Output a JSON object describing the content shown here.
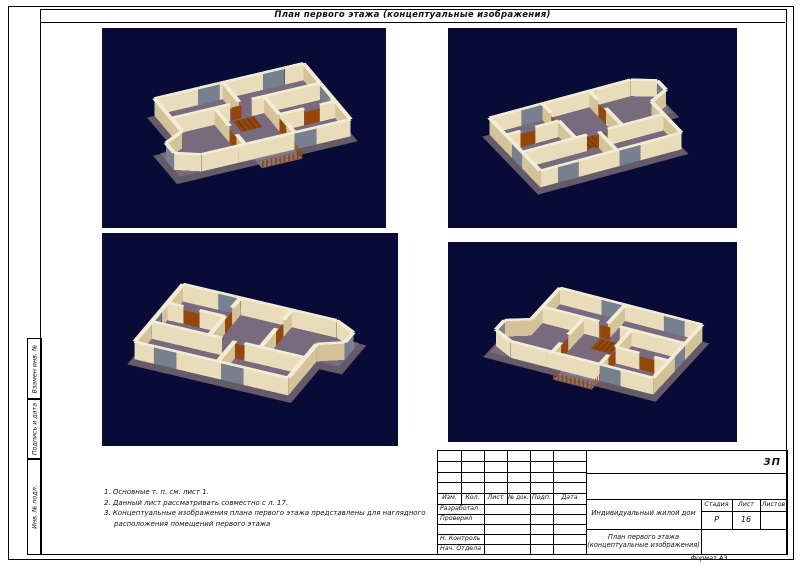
{
  "page_title": "План первого этажа (концептуальные изображения)",
  "doc_code": "ЗП",
  "format_label": "Формат А3",
  "notes": [
    "1. Основные т. п. см. лист 1.",
    "2. Данный лист рассматривать совместно с л. 17.",
    "3. Концептуальные изображения плана первого этажа представлены для наглядного расположения помещений первого этажа"
  ],
  "margin_labels": [
    "Взамен инв. №",
    "Подпись и дата",
    "Инв. № подл."
  ],
  "title_block": {
    "revision_headers": [
      "Изм.",
      "Кол.",
      "Лист",
      "№ док.",
      "Подп.",
      "Дата"
    ],
    "signature_labels": [
      "Разработал",
      "Проверил",
      "",
      "Н. Контроль",
      "Нач. Отдела"
    ],
    "project_name": "Индивидуальный жилой дом",
    "drawing_name_line1": "План первого этажа",
    "drawing_name_line2": "(концептуальные изображения)",
    "stage_header": "Стадия",
    "sheet_header": "Лист",
    "sheets_header": "Листов",
    "stage": "Р",
    "sheet": "16",
    "sheets": ""
  },
  "render_colors": {
    "background": "#070b36",
    "wall_top": "#f3ecd6",
    "wall_light": "#e8dcba",
    "wall_dark": "#d4c298",
    "floor": "#796a7d",
    "base": "#645a68",
    "door_wood": "#94470a",
    "door_dark": "#6e3503",
    "glass": "#76808f",
    "terrace": "#857a87",
    "terrace_dark": "#6f6472"
  }
}
